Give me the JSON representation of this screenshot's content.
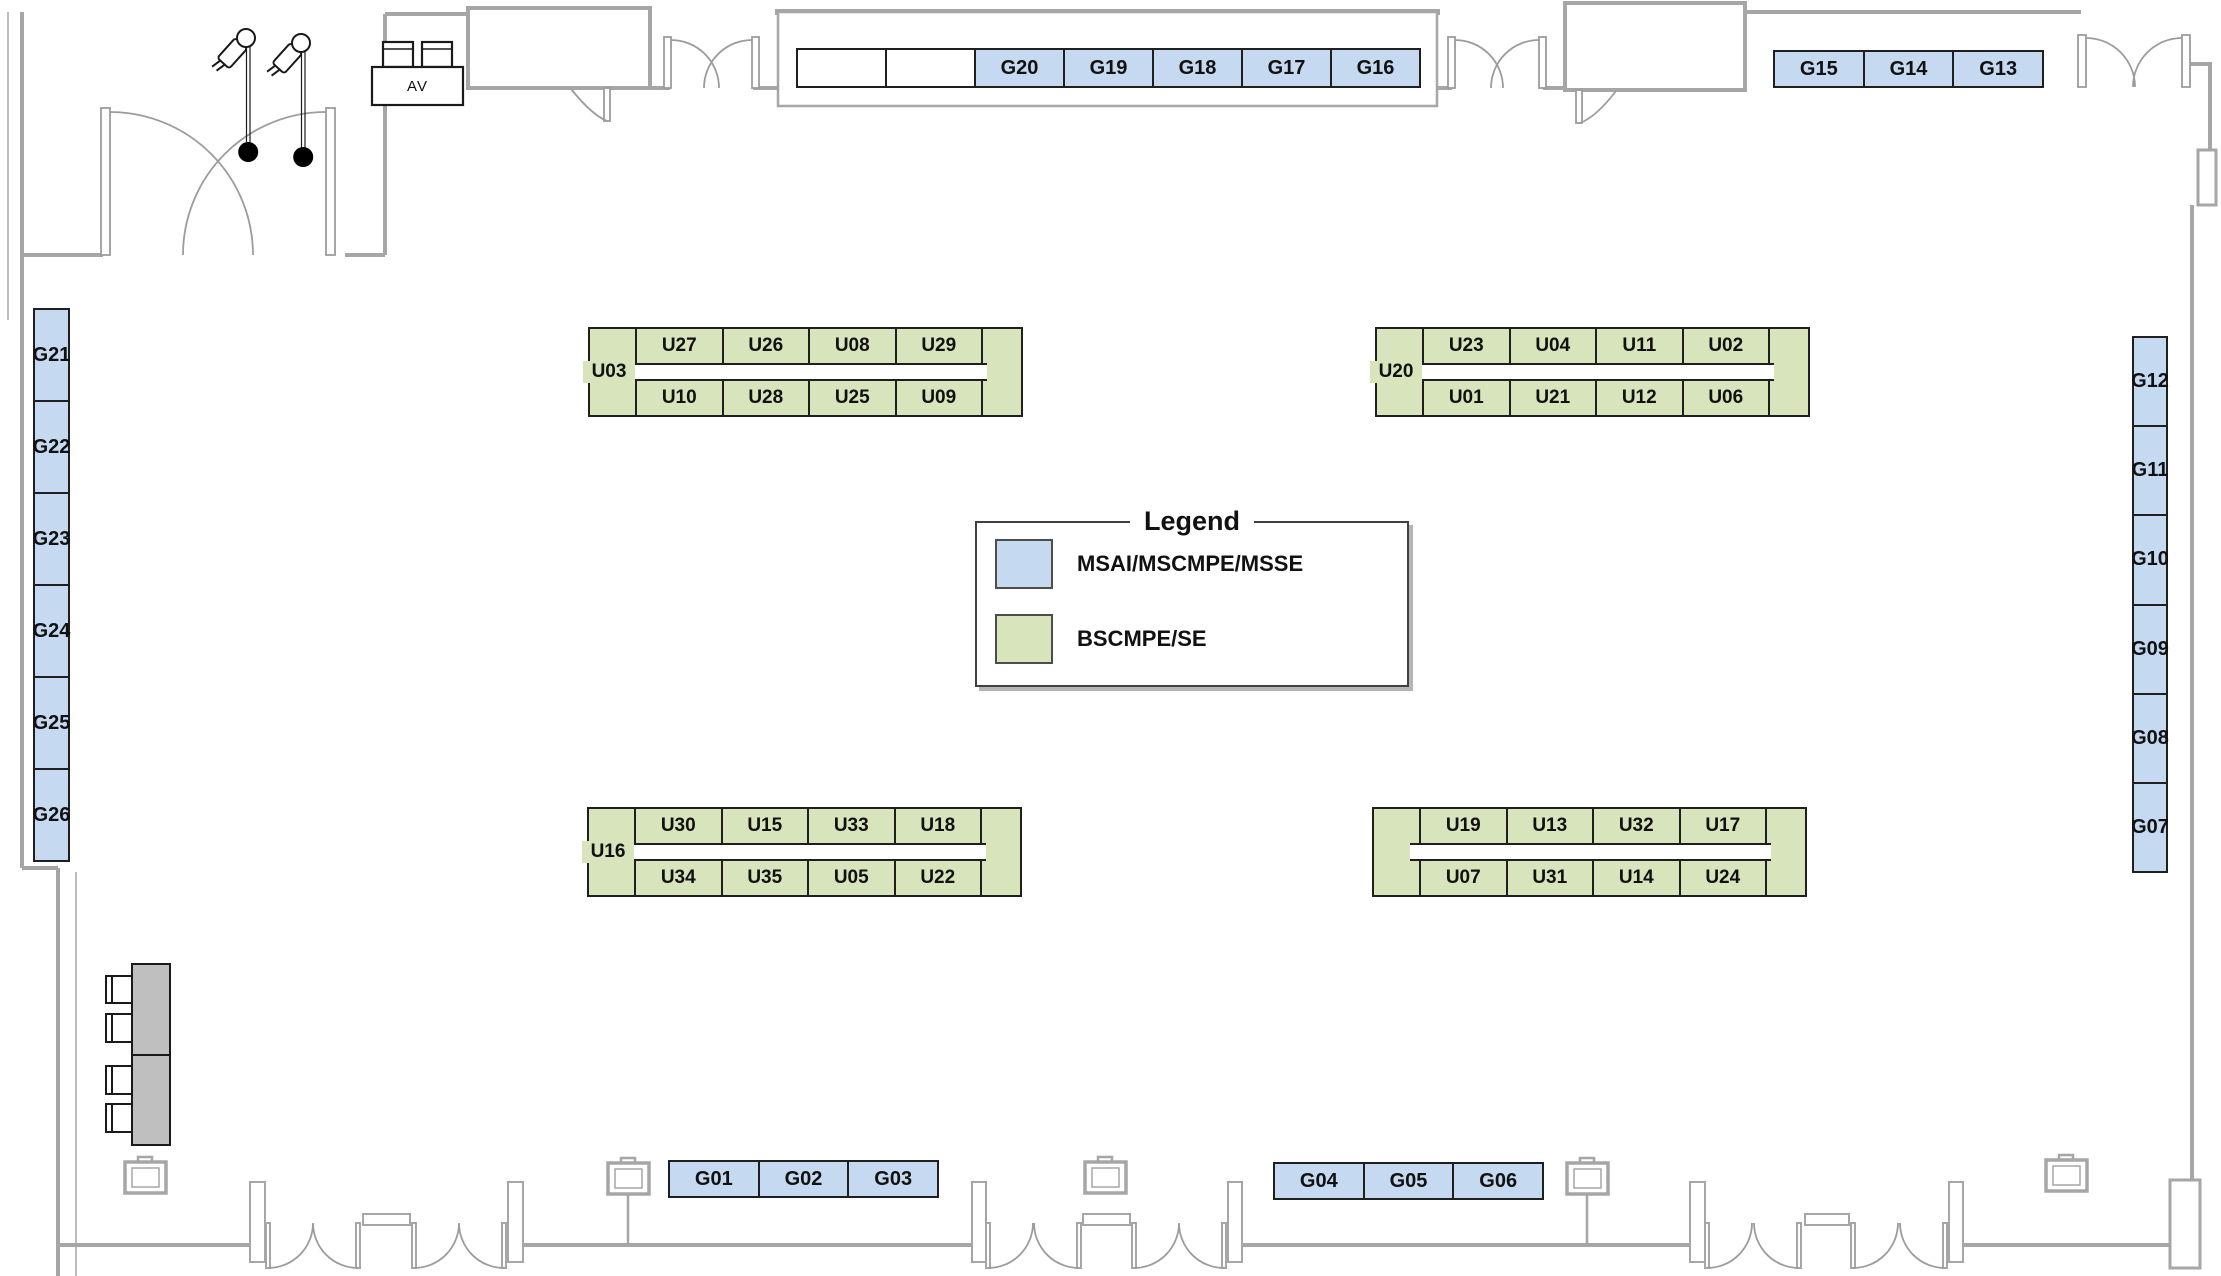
{
  "legend": {
    "title": "Legend",
    "items": [
      {
        "label": "MSAI/MSCMPE/MSSE",
        "color": "#c5d9f1"
      },
      {
        "label": "BSCMPE/SE",
        "color": "#d7e4bc"
      }
    ]
  },
  "colors": {
    "msai_blue": "#c5d9f1",
    "bscmpe_green": "#d7e4bc",
    "wall_gray": "#a6a6a6"
  },
  "equipment": {
    "av_label": "AV"
  },
  "strips": {
    "stage": [
      "",
      "",
      "G20",
      "G19",
      "G18",
      "G17",
      "G16"
    ],
    "north_east": [
      "G15",
      "G14",
      "G13"
    ],
    "west": [
      "G21",
      "G22",
      "G23",
      "G24",
      "G25",
      "G26"
    ],
    "east": [
      "G12",
      "G11",
      "G10",
      "G09",
      "G08",
      "G07"
    ],
    "south_left": [
      "G01",
      "G02",
      "G03"
    ],
    "south_right": [
      "G04",
      "G05",
      "G06"
    ]
  },
  "islands": [
    {
      "label": "U03",
      "top": [
        "U27",
        "U26",
        "U08",
        "U29"
      ],
      "bottom": [
        "U10",
        "U28",
        "U25",
        "U09"
      ]
    },
    {
      "label": "U20",
      "top": [
        "U23",
        "U04",
        "U11",
        "U02"
      ],
      "bottom": [
        "U01",
        "U21",
        "U12",
        "U06"
      ]
    },
    {
      "label": "U16",
      "top": [
        "U30",
        "U15",
        "U33",
        "U18"
      ],
      "bottom": [
        "U34",
        "U35",
        "U05",
        "U22"
      ]
    },
    {
      "label": "",
      "top": [
        "U19",
        "U13",
        "U32",
        "U17"
      ],
      "bottom": [
        "U07",
        "U31",
        "U14",
        "U24"
      ]
    }
  ]
}
